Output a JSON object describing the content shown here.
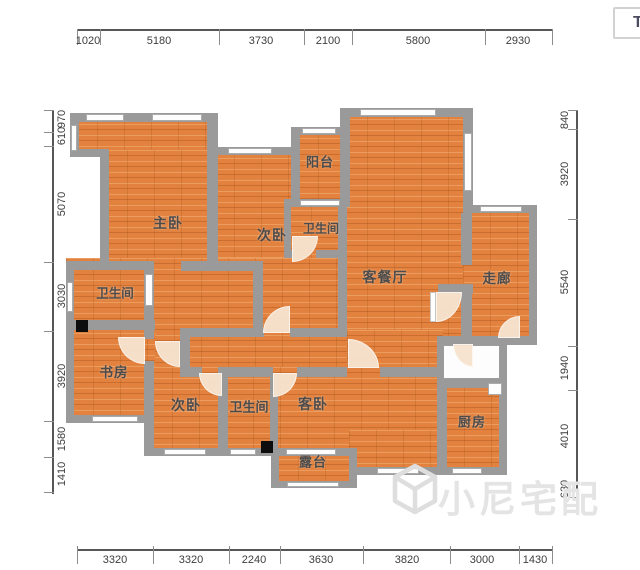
{
  "window_frame": {
    "corner_button_label": "T"
  },
  "floorplan": {
    "rooms": [
      {
        "id": "master-bedroom",
        "label": "主卧"
      },
      {
        "id": "bedroom-2",
        "label": "次卧"
      },
      {
        "id": "balcony",
        "label": "阳台"
      },
      {
        "id": "bathroom-1",
        "label": "卫生间"
      },
      {
        "id": "living-dining-room",
        "label": "客餐厅"
      },
      {
        "id": "corridor",
        "label": "走廊"
      },
      {
        "id": "bathroom-2",
        "label": "卫生间"
      },
      {
        "id": "study",
        "label": "书房"
      },
      {
        "id": "bedroom-3",
        "label": "次卧"
      },
      {
        "id": "bathroom-3",
        "label": "卫生间"
      },
      {
        "id": "guest-bedroom",
        "label": "客卧"
      },
      {
        "id": "kitchen",
        "label": "厨房"
      },
      {
        "id": "terrace",
        "label": "露台"
      }
    ],
    "dimensions_mm": {
      "top": [
        "1020",
        "5180",
        "3730",
        "2100",
        "5800",
        "2930"
      ],
      "bottom": [
        "3320",
        "3320",
        "2240",
        "3630",
        "3820",
        "3000",
        "1430"
      ],
      "left": [
        "970",
        "610",
        "5070",
        "3030",
        "3920",
        "1580",
        "1410"
      ],
      "right": [
        "840",
        "3920",
        "5540",
        "1940",
        "4010",
        "630"
      ]
    }
  },
  "watermark": {
    "text": "小尼宅配",
    "logo": "cube-logo"
  },
  "colors": {
    "floor_fill": "#e2823e",
    "wall_fill": "#9a9a9a",
    "dimension_text": "#3d3d3d",
    "room_text": "#4b4b4b",
    "watermark_text": "#e4e4e4"
  }
}
